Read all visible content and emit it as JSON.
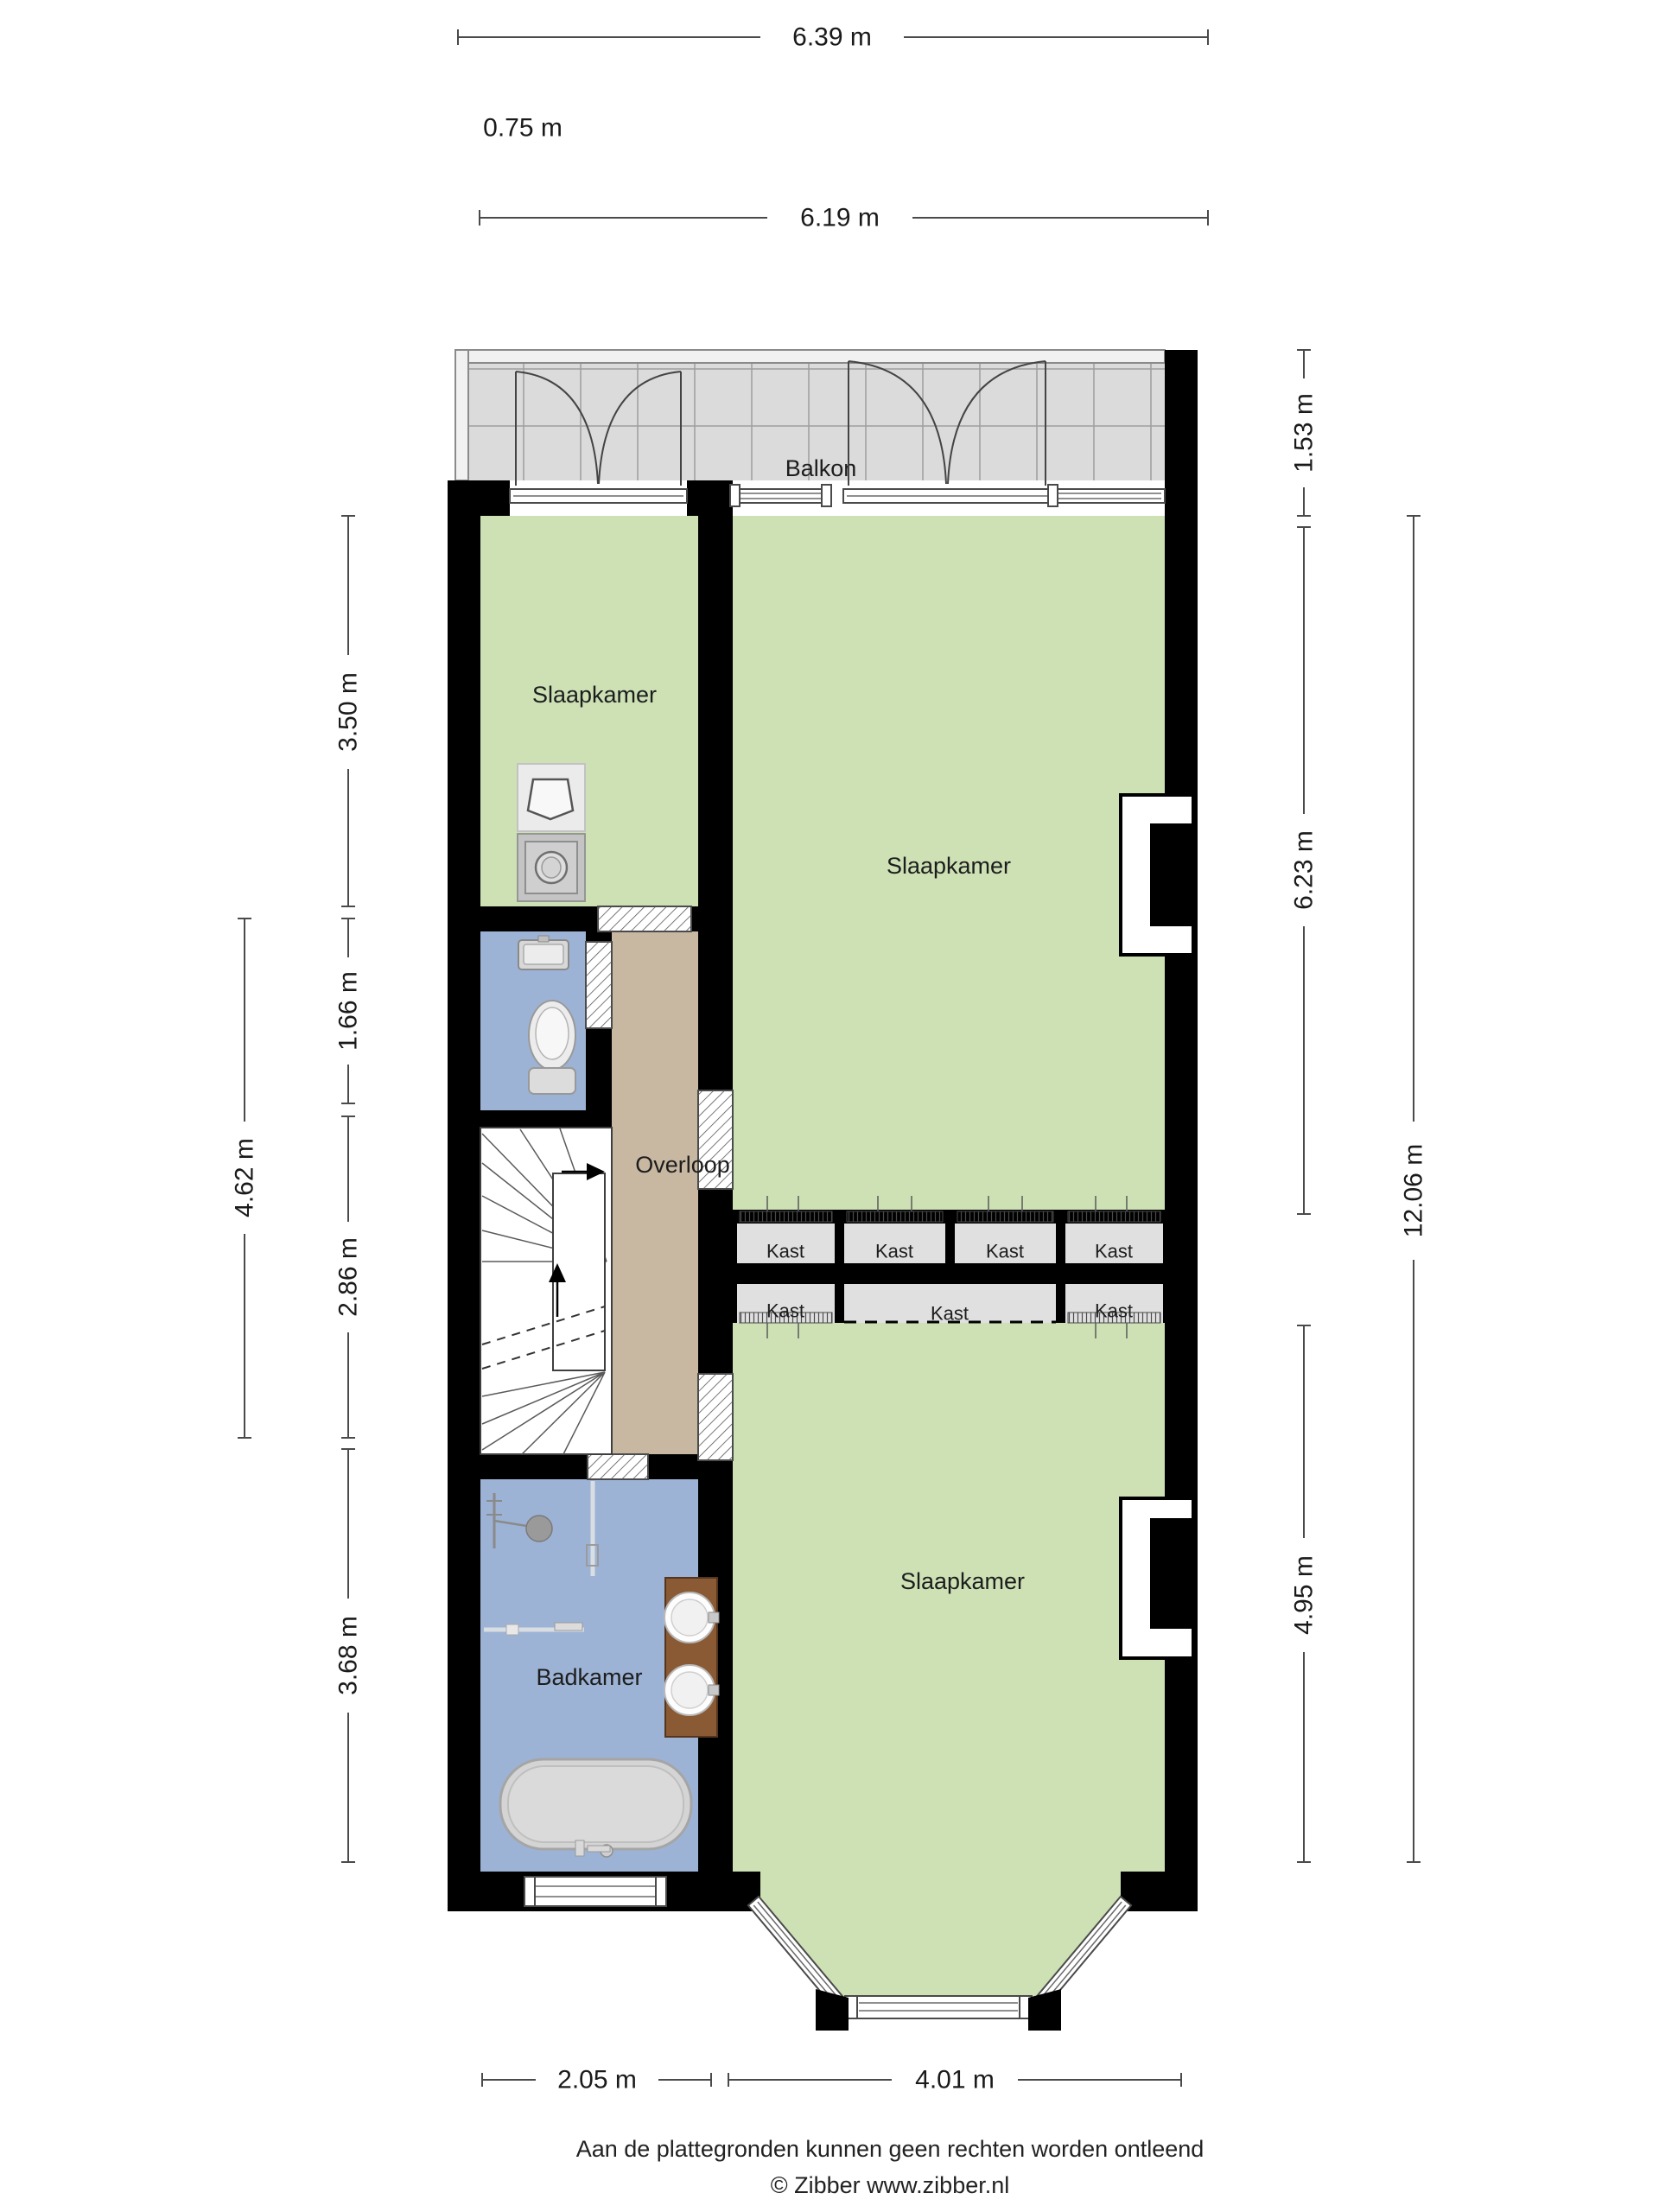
{
  "labels": {
    "balkon": "Balkon",
    "slaapkamer_left": "Slaapkamer",
    "slaapkamer_right": "Slaapkamer",
    "slaapkamer_bottom": "Slaapkamer",
    "overloop": "Overloop",
    "badkamer": "Badkamer"
  },
  "closets": [
    {
      "label": "Kast"
    },
    {
      "label": "Kast"
    },
    {
      "label": "Kast"
    },
    {
      "label": "Kast"
    },
    {
      "label": "Kast"
    },
    {
      "label": "Kast"
    },
    {
      "label": "Kast"
    }
  ],
  "dimensions": {
    "top": [
      {
        "label": "6.39 m"
      },
      {
        "label": "0.75 m"
      },
      {
        "label": "6.19 m"
      }
    ],
    "left": [
      {
        "label": "3.50 m"
      },
      {
        "label": "1.66 m"
      },
      {
        "label": "2.86 m"
      },
      {
        "label": "3.68 m"
      },
      {
        "label": "4.62 m"
      }
    ],
    "right": [
      {
        "label": "1.53 m"
      },
      {
        "label": "6.23 m"
      },
      {
        "label": "4.95 m"
      },
      {
        "label": "12.06 m"
      }
    ],
    "bottom": [
      {
        "label": "2.05 m"
      },
      {
        "label": "4.01 m"
      }
    ]
  },
  "footer": {
    "disclaimer": "Aan de plattegronden kunnen geen rechten worden ontleend",
    "copyright": "© Zibber www.zibber.nl"
  },
  "colors": {
    "bedroom_green": "#cde1b5",
    "hallway_tan": "#c8b8a2",
    "bathroom_blue": "#9db3d5",
    "balcony_tile": "#dbdbdb",
    "closet_gray": "#e0e0e0",
    "wall_black": "#000000"
  }
}
